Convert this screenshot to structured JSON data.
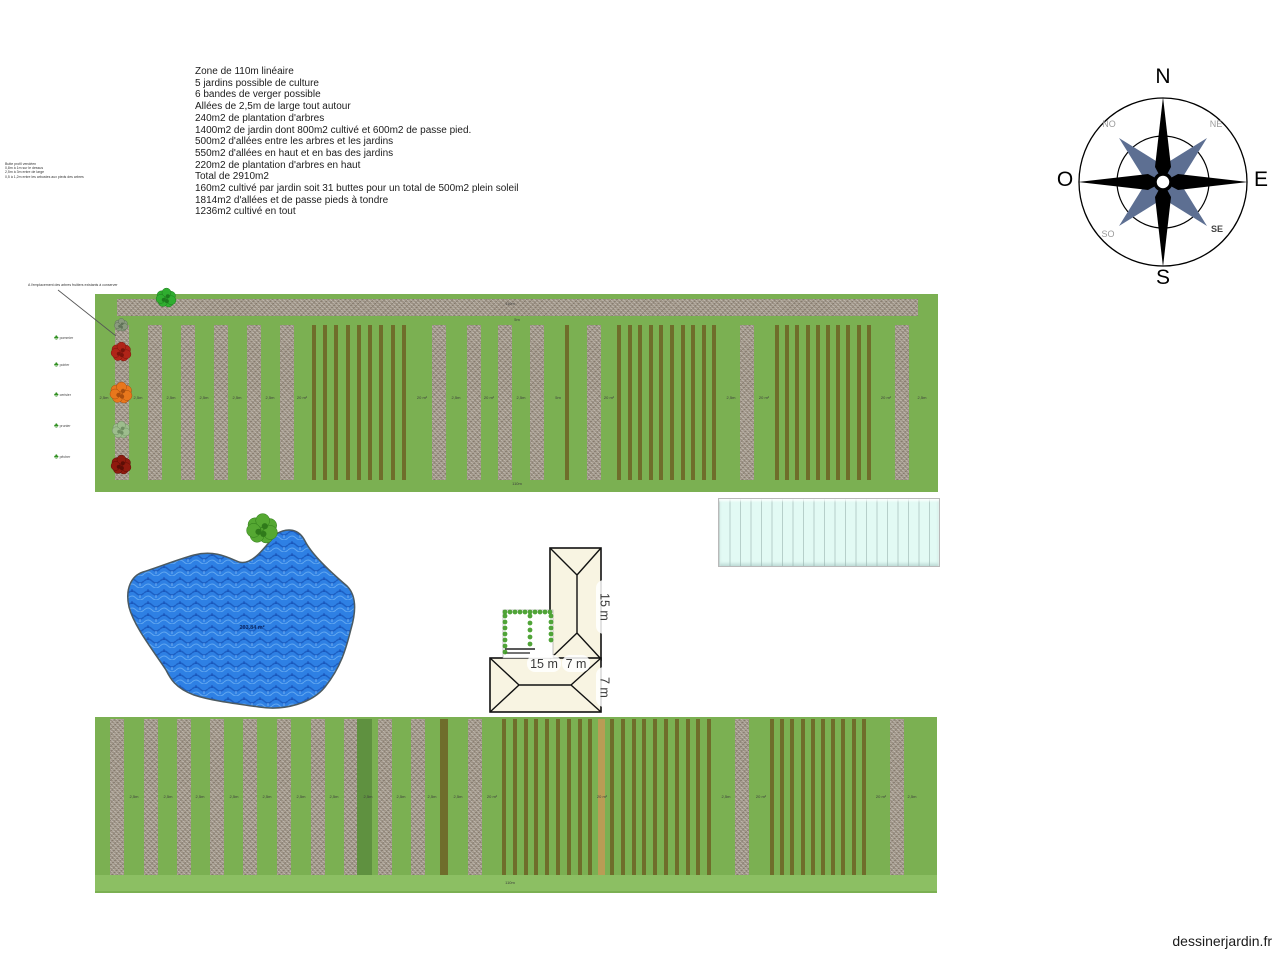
{
  "watermark": "dessinerjardin.fr",
  "summary": {
    "lines": [
      "Zone de 110m linéaire",
      "5 jardins possible de culture",
      "6 bandes de verger possible",
      "Allées de 2,5m de large tout autour",
      "240m2 de plantation d'arbres",
      "1400m2 de jardin dont 800m2 cultivé et 600m2 de passe pied.",
      "500m2 d'allées entre les arbres et les jardins",
      "550m2 d'allées en haut et en bas des jardins",
      "220m2 de plantation d'arbres en haut",
      "Total de 2910m2",
      "160m2 cultivé par jardin soit 31 buttes pour un total de 500m2 plein soleil",
      "1814m2 d'allées et de passe pieds à tondre",
      "1236m2 cultivé en tout"
    ]
  },
  "profile_note": {
    "lines": [
      "Butte profil vendéen",
      "0,8m à 1m sur le dessus",
      "2,5m à 3m entre de large",
      "0,5 à 1,2m entre les arbustes aux pieds des arbres"
    ]
  },
  "tree_note": "A l'emplacement des arbres fruitiers existants à conserver",
  "compass": {
    "n": "N",
    "s": "S",
    "e": "E",
    "o": "O",
    "ne": "NE",
    "no": "NO",
    "se": "SE",
    "so": "SO"
  },
  "pond": {
    "area_label": "203.84 m²"
  },
  "house": {
    "dim_height": "15 m",
    "dim_width": "15 m",
    "dim_depth_a": "7 m",
    "dim_depth_b": "7 m"
  },
  "legend": {
    "glyph": "♣",
    "items": [
      {
        "label": "pommier",
        "x": 54,
        "y": 329
      },
      {
        "label": "poirier",
        "x": 54,
        "y": 356
      },
      {
        "label": "cerisier",
        "x": 54,
        "y": 386
      },
      {
        "label": "prunier",
        "x": 54,
        "y": 417
      },
      {
        "label": "pêcher",
        "x": 54,
        "y": 448
      }
    ]
  },
  "colors": {
    "plot_green": "#7bb052",
    "band_green": "#8cbf63",
    "gravel": "#a89e90",
    "bed_olive": "#6f6d2b",
    "bed_tan": "#b99c55",
    "dark_green": "#5f9140",
    "pond_blue": "#2e80e4",
    "greenhouse_cyan": "#e2faf4",
    "house_cream": "#f8f4e2"
  },
  "plots": [
    {
      "name": "top-garden",
      "rect": {
        "x": 95,
        "y": 294,
        "w": 843,
        "h": 198
      },
      "bands": [
        {
          "type": "gravel",
          "x": 117,
          "y": 299,
          "w": 801,
          "h": 17
        }
      ],
      "stripTop": 325,
      "stripH": 155,
      "gravelW": 14,
      "gravel": [
        115,
        148,
        181,
        214,
        247,
        280,
        432,
        467,
        498,
        530,
        587,
        740,
        895
      ],
      "beds": [
        {
          "x": 312,
          "w": 101,
          "n": 9
        },
        {
          "x": 617,
          "w": 106,
          "n": 10
        },
        {
          "x": 775,
          "w": 102,
          "n": 10
        }
      ],
      "thin": [
        {
          "x": 565,
          "w": 4,
          "color": "olive"
        }
      ],
      "markersY": 396,
      "markers": [
        {
          "x": 138,
          "t": "2,5m"
        },
        {
          "x": 171,
          "t": "2,5m"
        },
        {
          "x": 204,
          "t": "2,5m"
        },
        {
          "x": 237,
          "t": "2,5m"
        },
        {
          "x": 270,
          "t": "2,5m"
        },
        {
          "x": 302,
          "t": "20 m²"
        },
        {
          "x": 422,
          "t": "20 m²"
        },
        {
          "x": 456,
          "t": "2,5m"
        },
        {
          "x": 489,
          "t": "20 m²"
        },
        {
          "x": 521,
          "t": "2,5m"
        },
        {
          "x": 558,
          "t": "5m"
        },
        {
          "x": 609,
          "t": "20 m²"
        },
        {
          "x": 731,
          "t": "2,5m"
        },
        {
          "x": 764,
          "t": "20 m²"
        },
        {
          "x": 886,
          "t": "20 m²"
        },
        {
          "x": 922,
          "t": "2,5m"
        }
      ],
      "extraLabels": [
        {
          "x": 510,
          "y": 302,
          "t": "110m"
        },
        {
          "x": 517,
          "y": 318,
          "t": "5m"
        },
        {
          "x": 517,
          "y": 482,
          "t": "110m"
        },
        {
          "x": 104,
          "y": 396,
          "t": "2,5m"
        }
      ]
    },
    {
      "name": "bottom-garden",
      "rect": {
        "x": 95,
        "y": 717,
        "w": 842,
        "h": 176
      },
      "bands": [
        {
          "type": "light",
          "x": 95,
          "y": 875,
          "w": 842,
          "h": 16
        }
      ],
      "stripTop": 719,
      "stripH": 156,
      "gravelW": 14,
      "gravel": [
        110,
        144,
        177,
        210,
        243,
        277,
        311,
        344,
        378,
        411,
        468,
        735,
        890
      ],
      "beds": [
        {
          "x": 502,
          "w": 216,
          "n": 20
        },
        {
          "x": 770,
          "w": 102,
          "n": 10
        }
      ],
      "thin": [
        {
          "x": 357,
          "w": 15,
          "color": "darkgreen"
        },
        {
          "x": 440,
          "w": 8,
          "color": "olive"
        },
        {
          "x": 598,
          "w": 7,
          "color": "tan"
        }
      ],
      "markersY": 795,
      "markers": [
        {
          "x": 134,
          "t": "2,5m"
        },
        {
          "x": 168,
          "t": "2,5m"
        },
        {
          "x": 200,
          "t": "2,5m"
        },
        {
          "x": 234,
          "t": "2,5m"
        },
        {
          "x": 267,
          "t": "2,5m"
        },
        {
          "x": 301,
          "t": "2,5m"
        },
        {
          "x": 334,
          "t": "2,5m"
        },
        {
          "x": 368,
          "t": "2,5m"
        },
        {
          "x": 401,
          "t": "2,5m"
        },
        {
          "x": 432,
          "t": "2,5m"
        },
        {
          "x": 458,
          "t": "2,5m"
        },
        {
          "x": 492,
          "t": "20 m²"
        },
        {
          "x": 602,
          "t": "20 m²"
        },
        {
          "x": 726,
          "t": "2,5m"
        },
        {
          "x": 761,
          "t": "20 m²"
        },
        {
          "x": 881,
          "t": "20 m²"
        },
        {
          "x": 912,
          "t": "2,5m"
        }
      ],
      "extraLabels": [
        {
          "x": 510,
          "y": 881,
          "t": "110m"
        }
      ]
    }
  ],
  "trees": [
    {
      "x": 166,
      "y": 298,
      "r": 9,
      "c": "#2fae2f",
      "d": "#1e7a1e",
      "name": "tree-green-top"
    },
    {
      "x": 121,
      "y": 325,
      "r": 6,
      "c": "#8a9a7e",
      "d": "#5f7258",
      "name": "plant-small"
    },
    {
      "x": 121,
      "y": 352,
      "r": 9,
      "c": "#b02418",
      "d": "#7a140c",
      "name": "tree-red"
    },
    {
      "x": 121,
      "y": 393,
      "r": 10,
      "c": "#e8771c",
      "d": "#a84e0e",
      "name": "tree-orange"
    },
    {
      "x": 121,
      "y": 430,
      "r": 8,
      "c": "#9dbd8d",
      "d": "#6f8f62",
      "name": "tree-pale-green"
    },
    {
      "x": 121,
      "y": 465,
      "r": 9,
      "c": "#8f1a0e",
      "d": "#5c0e06",
      "name": "tree-dark-red"
    },
    {
      "x": 262,
      "y": 529,
      "r": 14,
      "c": "#55a832",
      "d": "#2f7a1a",
      "name": "pond-tree"
    }
  ]
}
